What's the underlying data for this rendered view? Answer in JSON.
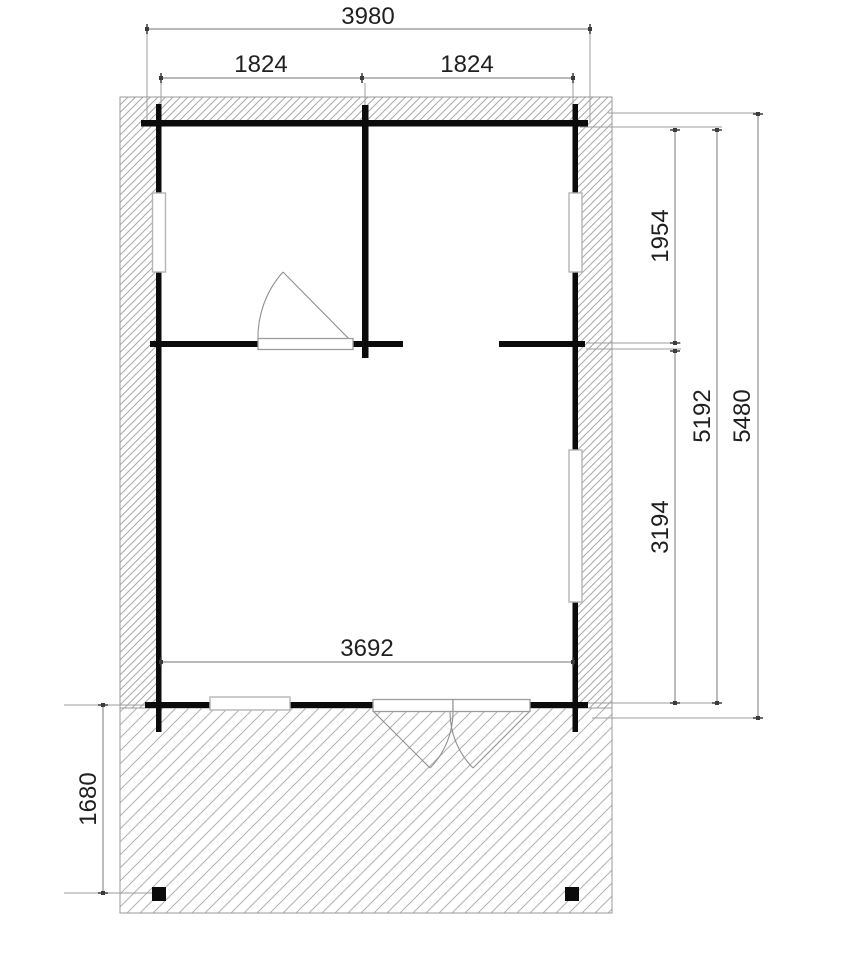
{
  "drawing": {
    "type": "floor-plan",
    "dimensions": {
      "overall_width": "3980",
      "bay_width_left": "1824",
      "bay_width_right": "1824",
      "right_depth_upper": "1954",
      "interior_length": "5192",
      "overall_length": "5480",
      "right_depth_lower": "3194",
      "interior_width": "3692",
      "terrace_depth": "1680"
    },
    "colors": {
      "wall": "#0b0b0b",
      "dimension_line": "#8f8f8f",
      "witness_line": "#9e9e9e",
      "dimension_text": "#1f1f1f",
      "hatch_dense": "#a8a8a8",
      "hatch_light": "#b2b2b2",
      "window_frame": "#b5b5b5",
      "door_swing": "#8f8f8f",
      "background": "#ffffff"
    },
    "elements": {
      "windows": [
        "left-wall-window",
        "right-wall-window-upper",
        "right-wall-window-lower",
        "front-wall-window"
      ],
      "doors": [
        "interior-single-door",
        "front-double-door"
      ],
      "posts": [
        "terrace-post-left",
        "terrace-post-right"
      ]
    }
  }
}
